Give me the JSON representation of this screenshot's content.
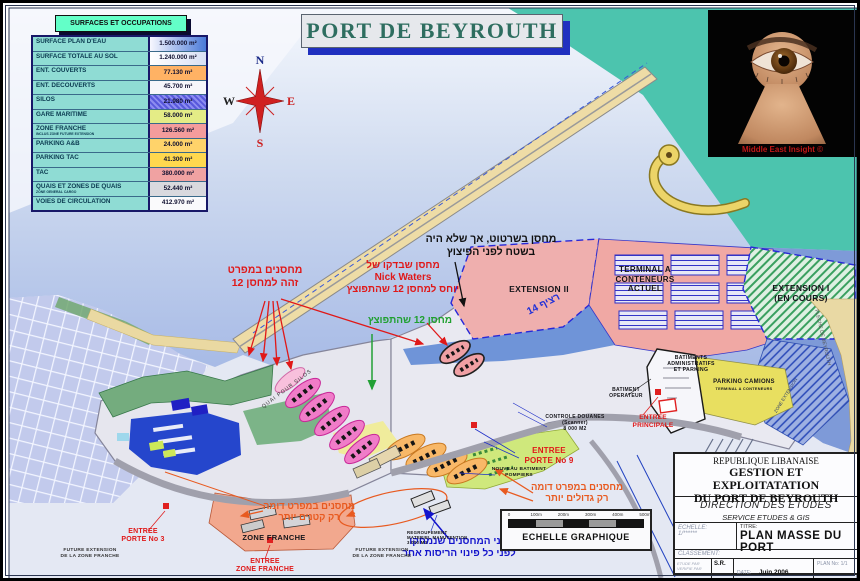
{
  "title": "PORT DE BEYROUTH",
  "legend": {
    "header": "SURFACES ET OCCUPATIONS",
    "rows": [
      {
        "label": "SURFACE PLAN D'EAU",
        "value": "1.500.000 m²",
        "bg": "linear-gradient(90deg,#f8f8ff 0%,#4a7ad8 100%)"
      },
      {
        "label": "SURFACE TOTALE AU SOL",
        "value": "1.240.000 m²",
        "bg": "linear-gradient(90deg,#ffffff,#d8e0f4)"
      },
      {
        "label": "ENT. COUVERTS",
        "value": "77.130 m²",
        "bg": "#ffb264"
      },
      {
        "label": "ENT. DECOUVERTS",
        "value": "45.700 m²",
        "bg": "#f6f6fa"
      },
      {
        "label": "SILOS",
        "value": "21.980 m²",
        "bg": "repeating-linear-gradient(45deg,#5858dc 0,#5858dc 2px,#8c8cf0 2px,#8c8cf0 4px)"
      },
      {
        "label": "GARE MARITIME",
        "value": "58.000 m²",
        "bg": "#e4ec86"
      },
      {
        "label": "ZONE FRANCHE",
        "sublabel": "INCLUS ZONE FUTURE EXTENSION",
        "value": "126.560 m²",
        "bg": "#f49c9c"
      },
      {
        "label": "PARKING A&B",
        "value": "24.000 m²",
        "bg": "#ffd36a"
      },
      {
        "label": "PARKING TAC",
        "value": "41.300 m²",
        "bg": "#ffd84e"
      },
      {
        "label": "TAC",
        "value": "380.000 m²",
        "bg": "#f0a2a2"
      },
      {
        "label": "QUAIS ET ZONES DE QUAIS",
        "sublabel": "ZONE GENERAL CARGO",
        "value": "52.440 m²",
        "bg": "#d9d9de"
      },
      {
        "label": "VOIES DE CIRCULATION",
        "value": "412.970 m²",
        "bg": "#fafafc"
      }
    ]
  },
  "compass": {
    "n": "N",
    "s": "S",
    "e": "E",
    "w": "W"
  },
  "watermark": {
    "caption": "Middle East  Insight ©"
  },
  "map_labels": {
    "extension2": "EXTENSION  II",
    "terminal_actuel": "TERMINAL A CONTENEURS\nACTUEL",
    "extension1": "EXTENSION I\n(EN COURS)",
    "parking1": "PARKING CAMIONS",
    "parking2": "TERMINAL A CONTENEURS",
    "batiments_admin": "BATIMENTS\nADMINISTRATIFS\nET PARKING",
    "batiment_operateur": "BATIMENT\nOPERATEUR",
    "controle_douanes": "CONTROLE DOUANES\n(Scanner)\n8 000 M2",
    "nouveau_batiment": "NOUVEAU BATIMENT\nPOMPIERS",
    "regroupement": "REGROUPEMENT\nMATERIEL MANUTENTION\n3 000 M3",
    "zone_franche": "ZONE  FRANCHE",
    "future_ext_1": "FUTURE EXTENSION\nDE LA ZONE FRANCHE",
    "future_ext_2": "FUTURE EXTENSION\nDE LA ZONE FRANCHE",
    "quai_silos": "QUAI POUR SILOS",
    "quai14": "רציף 14",
    "fleche": "FLECHE DE BEYROUTH",
    "zone_extension": "ZONE EXTENSION"
  },
  "entrances": {
    "porte3": "ENTREE\nPORTE No 3",
    "zone_franche": "ENTREE\nZONE FRANCHE",
    "porte9": "ENTREE\nPORTE  No 9",
    "principale": "ENTREE\nPRINCIPALE"
  },
  "annotations": {
    "same_spec": "מחסנים במפרט\nזהה למחסן 12",
    "not_on_site": "מחסן בשרטוט, אך שלא היה\nבשטח לפני הפיצוץ",
    "nick_checked": "מחסן שבדקו של\nNick Waters\nיוחס למחסן 12 שהתפוצץ",
    "warehouse12": "מחסן 12 שהתפוצץ",
    "similar_bigger": "מחסנים במפרט דומה\nרק גדולים יותר",
    "similar_smaller": "מחסנים במפרט דומה\nרק קטנים יותר",
    "two_demolished": "שני המחסנים שנמחקו\nלפני כל פינוי הריסות אחר"
  },
  "scalebar": {
    "label": "ECHELLE GRAPHIQUE",
    "ticks": [
      "0",
      "100m",
      "200m",
      "300m",
      "400m",
      "500m"
    ]
  },
  "title_block": {
    "country": "REPUBLIQUE LIBANAISE",
    "org1": "GESTION ET EXPLOITATATION",
    "org2": "DU PORT DE BEYROUTH",
    "dept": "DIRECTION DES ETUDES",
    "service": "SERVICE ETUDES & GIS",
    "echelle_label": "ECHELLE:",
    "echelle_value": "1/******",
    "titre_label": "TITRE:",
    "titre_value": "PLAN MASSE DU PORT",
    "classement_label": "CLASSEMENT:",
    "etude_label": "ETUDE PAR",
    "verifie_label": "VERIFIE PAR",
    "author": "S.R.",
    "date_label": "DATE:",
    "date_value": "Juin 2006",
    "plan_label": "PLAN No:",
    "plan_value": "1/1"
  },
  "colors": {
    "sea": "#9fb4e4",
    "sea_teal": "#4cc4ae",
    "terminal_pink": "#f0a8a4",
    "extension_green": "#3aa060",
    "parking_yellow": "#e8df60",
    "zone_franche_salmon": "#f2a88e",
    "annotation_red": "#e01818",
    "annotation_green": "#22a035",
    "annotation_blue": "#1414cc",
    "annotation_orange": "#e85a20"
  }
}
